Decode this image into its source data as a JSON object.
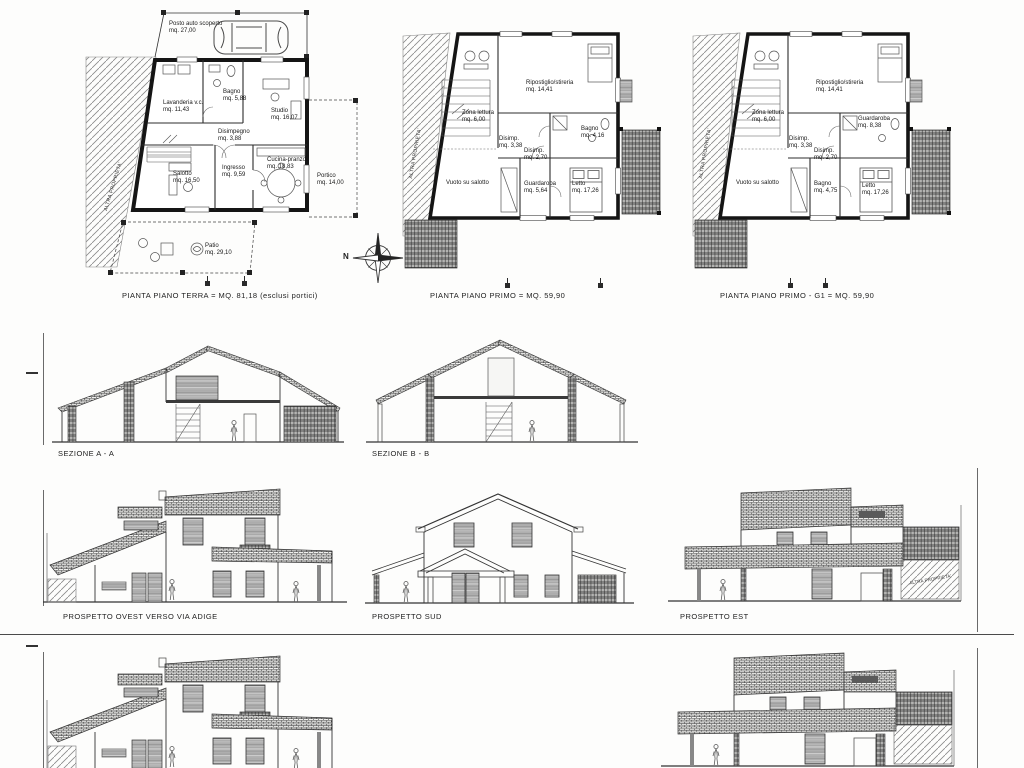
{
  "compass": {
    "north_label": "N"
  },
  "plans": [
    {
      "caption": "PIANTA PIANO TERRA = MQ. 81,18 (esclusi portici)",
      "side_label": "ALTRA PROPRIETA'",
      "rooms": [
        {
          "name": "Posto auto scoperto",
          "area": "mq. 27,00"
        },
        {
          "name": "Lavanderia v.c.",
          "area": "mq. 11,43"
        },
        {
          "name": "Bagno",
          "area": "mq. 5,88"
        },
        {
          "name": "Studio",
          "area": "mq. 16,07"
        },
        {
          "name": "Disimpegno",
          "area": "mq. 3,88"
        },
        {
          "name": "Salotto",
          "area": "mq. 16,50"
        },
        {
          "name": "Ingresso",
          "area": "mq. 9,59"
        },
        {
          "name": "Cucina-pranzo",
          "area": "mq. 18,83"
        },
        {
          "name": "Portico",
          "area": "mq. 14,00"
        },
        {
          "name": "Patio",
          "area": "mq. 29,10"
        }
      ]
    },
    {
      "caption": "PIANTA PIANO PRIMO = MQ. 59,90",
      "side_label": "ALTRA PROPRIETA'",
      "rooms": [
        {
          "name": "Zona lettura",
          "area": "mq. 6,00"
        },
        {
          "name": "Ripostiglio/stireria",
          "area": "mq. 14,41"
        },
        {
          "name": "Disimp.",
          "area": "mq. 3,38"
        },
        {
          "name": "Disimp.",
          "area": "mq. 2,70"
        },
        {
          "name": "Bagno",
          "area": "mq. 4,16"
        },
        {
          "name": "Guardaroba",
          "area": "mq. 5,64"
        },
        {
          "name": "Letto",
          "area": "mq. 17,26"
        },
        {
          "name": "Vuoto su salotto",
          "area": ""
        }
      ]
    },
    {
      "caption": "PIANTA PIANO PRIMO - G1 = MQ. 59,90",
      "side_label": "ALTRA PROPRIETA'",
      "rooms": [
        {
          "name": "Zona lettura",
          "area": "mq. 6,00"
        },
        {
          "name": "Ripostiglio/stireria",
          "area": "mq. 14,41"
        },
        {
          "name": "Disimp.",
          "area": "mq. 3,38"
        },
        {
          "name": "Disimp.",
          "area": "mq. 2,70"
        },
        {
          "name": "Guardaroba",
          "area": "mq. 8,38"
        },
        {
          "name": "Bagno",
          "area": "mq. 4,75"
        },
        {
          "name": "Letto",
          "area": "mq. 17,26"
        },
        {
          "name": "Vuoto su salotto",
          "area": ""
        }
      ]
    }
  ],
  "sections": [
    {
      "caption": "SEZIONE A - A"
    },
    {
      "caption": "SEZIONE B - B"
    }
  ],
  "elevations": [
    {
      "caption": "PROSPETTO OVEST VERSO VIA ADIGE"
    },
    {
      "caption": "PROSPETTO SUD"
    },
    {
      "caption": "PROSPETTO EST",
      "property_label": "ALTRA PROPRIETA'"
    }
  ]
}
